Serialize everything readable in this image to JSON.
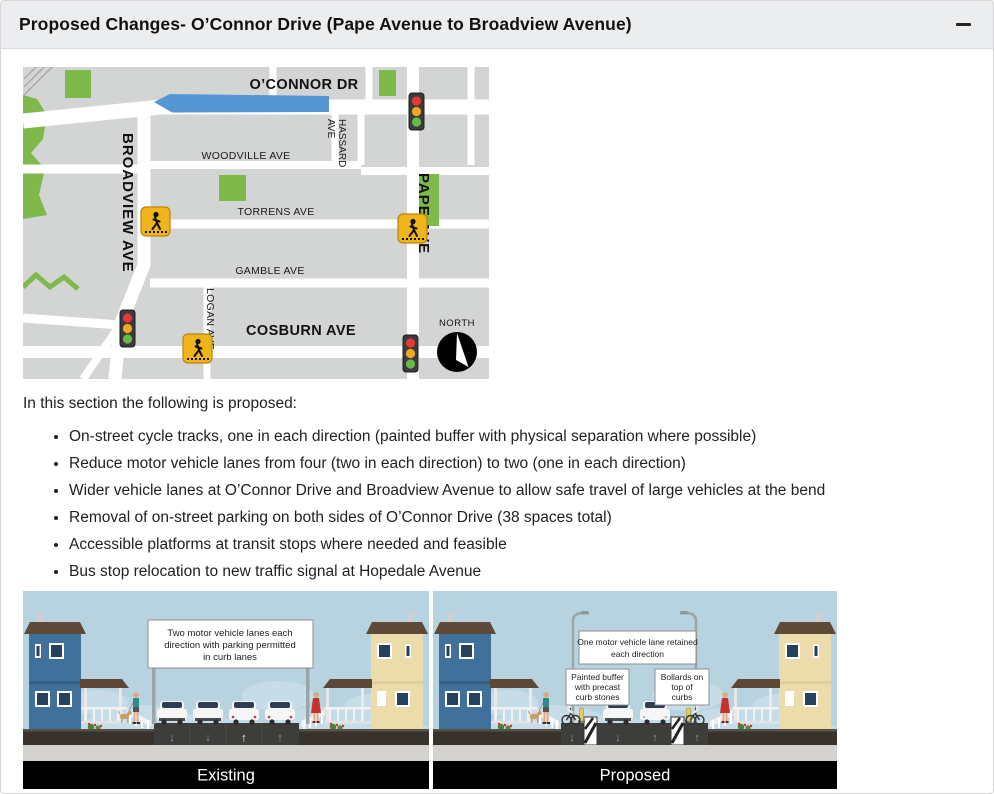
{
  "header": {
    "title": "Proposed Changes- O’Connor Drive (Pape Avenue to Broadview Avenue)"
  },
  "intro": "In this section the following is proposed:",
  "proposals": [
    "On-street cycle tracks, one in each direction (painted buffer with physical separation where possible)",
    "Reduce motor vehicle lanes from four (two in each direction) to two (one in each direction)",
    "Wider vehicle lanes at O’Connor Drive and Broadview Avenue to allow safe travel of large vehicles at the bend",
    "Removal of on-street parking on both sides of O’Connor Drive (38 spaces total)",
    "Accessible platforms at transit stops where needed and feasible",
    "Bus stop relocation to new traffic signal at Hopedale Avenue"
  ],
  "map": {
    "streets": {
      "oconnor": "O’CONNOR DR",
      "woodville": "WOODVILLE AVE",
      "hassard_line1": "HASSARD",
      "hassard_line2": "AVE",
      "torrens": "TORRENS AVE",
      "gamble": "GAMBLE AVE",
      "cosburn": "COSBURN AVE",
      "broadview": "BROADVIEW AVE",
      "pape": "PAPE AVE",
      "logan": "LOGAN AVE"
    },
    "north_label": "NORTH",
    "colors": {
      "highlight_blue": "#5596d3",
      "park_green": "#7fb94c",
      "signal_red": "#e53935",
      "signal_amber": "#f5a623",
      "signal_green": "#66bb44",
      "crosswalk_yellow": "#f0b41b"
    }
  },
  "figures": {
    "existing": {
      "label": "Existing",
      "sign_lines": [
        "Two motor vehicle lanes each",
        "direction with parking permitted",
        "in curb lanes"
      ]
    },
    "proposed": {
      "label": "Proposed",
      "sign1_lines": [
        "One motor vehicle lane retained",
        "each direction"
      ],
      "sign2_lines": [
        "Painted buffer",
        "with precast",
        "curb stones"
      ],
      "sign3_lines": [
        "Bollards on",
        "top of",
        "curbs"
      ]
    }
  }
}
